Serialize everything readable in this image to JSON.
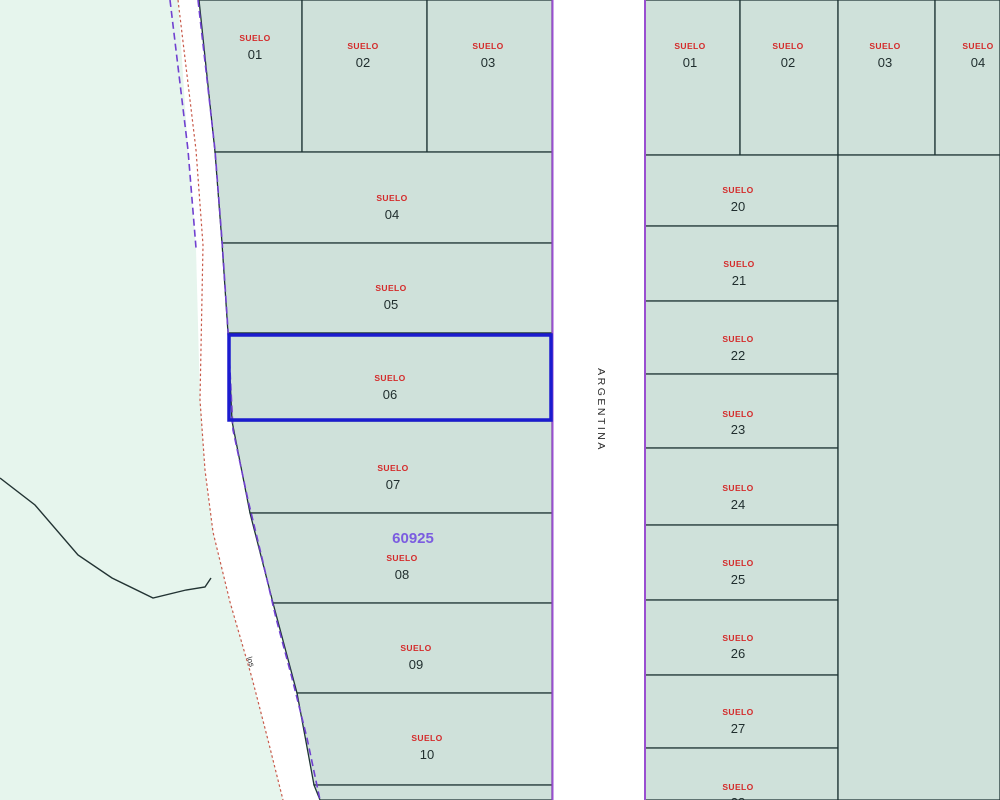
{
  "labels": {
    "street": "ARGENTINA",
    "road": "los",
    "selected_code": "60925"
  },
  "colors": {
    "background": "#e6f5ed",
    "parcel_fill": "#cfe1da",
    "road_fill": "#ffffff",
    "street_edge_line": "#9a4fd0",
    "road_edge_purple_dashed": "#7040d0",
    "road_edge_red_dashed": "#c85a4a",
    "parcel_boundary": "#1e3434",
    "selection_outline": "#1b1bcf",
    "parcel_word_text": "#d42a2a",
    "parcel_number_text": "#1f2d2d",
    "selected_code_text": "#7b5ce0",
    "street_label_text": "#2a2a2a"
  },
  "left_block": {
    "parcels": [
      {
        "name": "SUELO",
        "number": "01"
      },
      {
        "name": "SUELO",
        "number": "02"
      },
      {
        "name": "SUELO",
        "number": "03"
      },
      {
        "name": "SUELO",
        "number": "04"
      },
      {
        "name": "SUELO",
        "number": "05"
      },
      {
        "name": "SUELO",
        "number": "06"
      },
      {
        "name": "SUELO",
        "number": "07"
      },
      {
        "name": "SUELO",
        "number": "08"
      },
      {
        "name": "SUELO",
        "number": "09"
      },
      {
        "name": "SUELO",
        "number": "10"
      }
    ],
    "selected_parcel_number": "06"
  },
  "right_block": {
    "parcels": [
      {
        "name": "SUELO",
        "number": "01"
      },
      {
        "name": "SUELO",
        "number": "02"
      },
      {
        "name": "SUELO",
        "number": "03"
      },
      {
        "name": "SUELO",
        "number": "04"
      },
      {
        "name": "SUELO",
        "number": "20"
      },
      {
        "name": "SUELO",
        "number": "21"
      },
      {
        "name": "SUELO",
        "number": "22"
      },
      {
        "name": "SUELO",
        "number": "23"
      },
      {
        "name": "SUELO",
        "number": "24"
      },
      {
        "name": "SUELO",
        "number": "25"
      },
      {
        "name": "SUELO",
        "number": "26"
      },
      {
        "name": "SUELO",
        "number": "27"
      },
      {
        "name": "SUELO",
        "number": "28"
      }
    ]
  }
}
